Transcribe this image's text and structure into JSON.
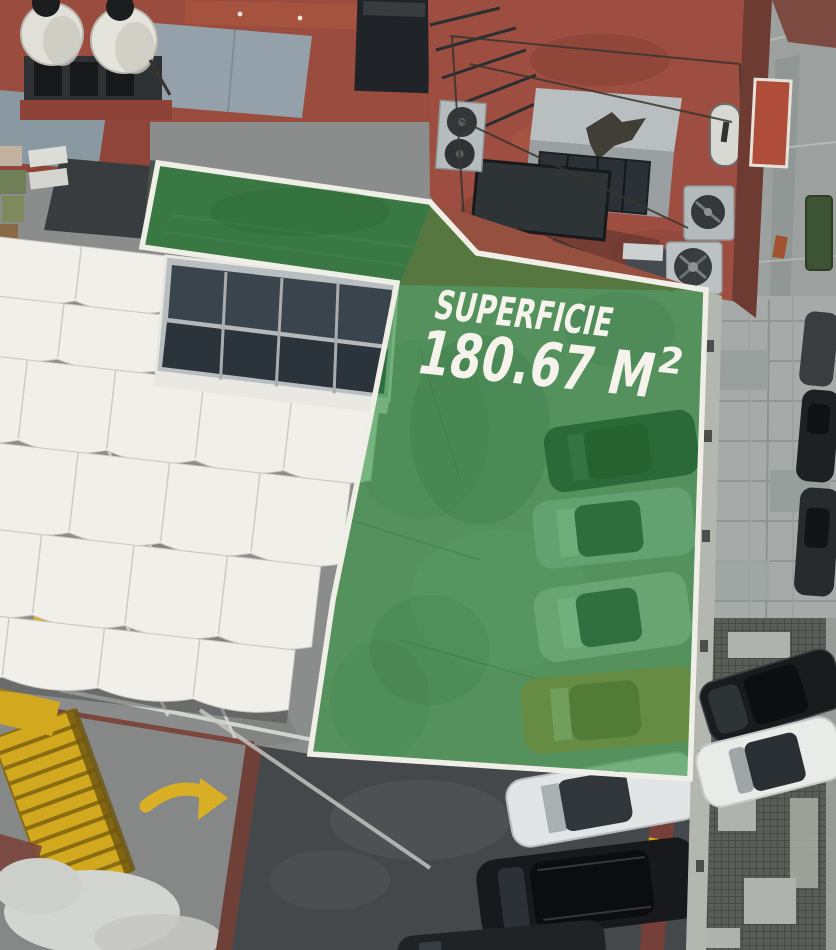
{
  "overlay": {
    "superficie_label": "SUPERFICIE",
    "area_value": "180.67 M",
    "area_superscript": "2",
    "green_fill": "#2F8F3F",
    "green_opacity": "0.62",
    "border_color": "#F0EFE7",
    "text_color": "#F5F3EC"
  },
  "scene": {
    "colors": {
      "red_roof": "#9A4C3F",
      "slate_roof": "#95A1AA",
      "awning_white": "#F0EFE9",
      "ramp_gray": "#8A8D8B",
      "asphalt_dark": "#45484A",
      "sidewalk_gray": "#A6ABAA",
      "grating_gray": "#5A5D57",
      "marking_yellow": "#D9AF25",
      "maroon_wall": "#6E3B33"
    }
  }
}
